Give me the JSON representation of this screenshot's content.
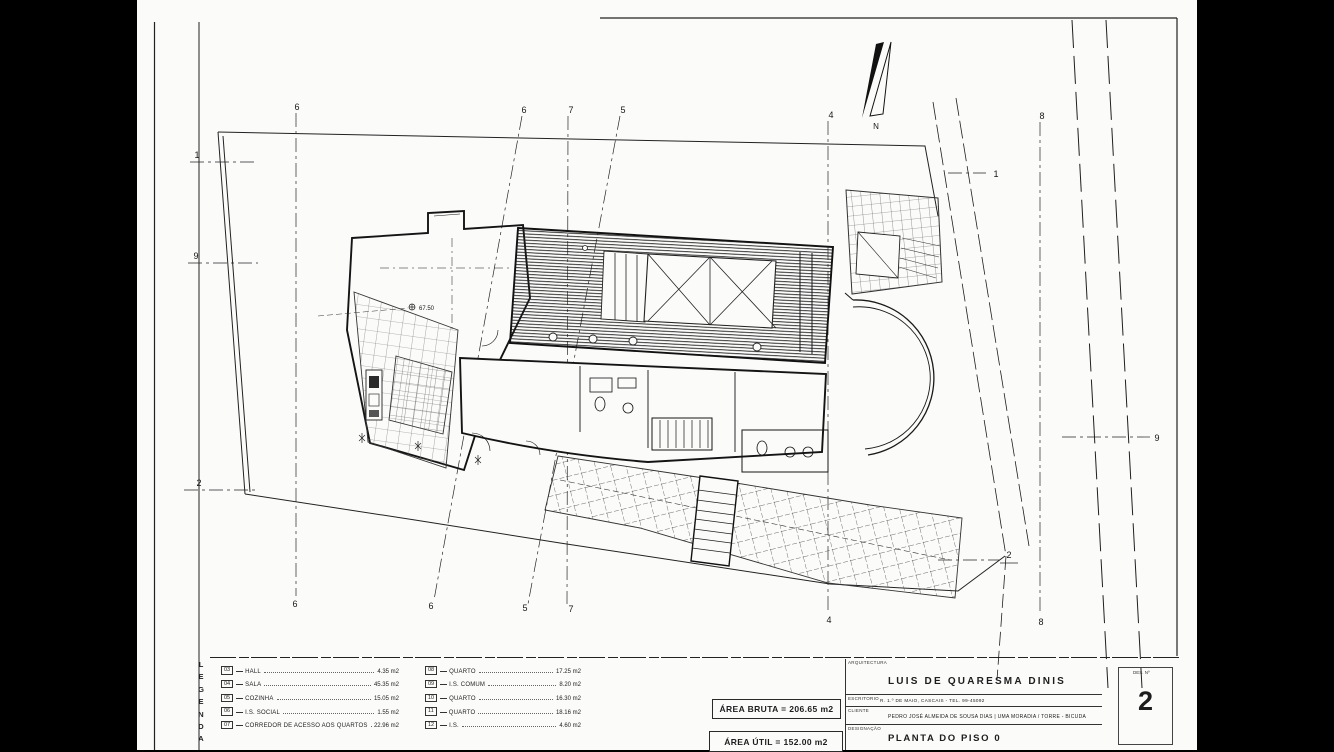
{
  "sheet": {
    "legend_title": "LEGENDA",
    "legend": {
      "left": [
        {
          "num": "03",
          "label": "HALL",
          "area": "4.35 m2"
        },
        {
          "num": "04",
          "label": "SALA",
          "area": "45.35 m2"
        },
        {
          "num": "05",
          "label": "COZINHA",
          "area": "15.05 m2"
        },
        {
          "num": "06",
          "label": "I.S. SOCIAL",
          "area": "1.55 m2"
        },
        {
          "num": "07",
          "label": "CORREDOR DE ACESSO AOS QUARTOS",
          "area": "22.96 m2"
        }
      ],
      "right": [
        {
          "num": "08",
          "label": "QUARTO",
          "area": "17.25 m2"
        },
        {
          "num": "09",
          "label": "I.S. COMUM",
          "area": "8.20 m2"
        },
        {
          "num": "10",
          "label": "QUARTO",
          "area": "16.30 m2"
        },
        {
          "num": "11",
          "label": "QUARTO",
          "area": "18.16 m2"
        },
        {
          "num": "12",
          "label": "I.S.",
          "area": "4.60 m2"
        }
      ]
    },
    "area_boxes": {
      "bruta": "ÁREA BRUTA = 206.65 m2",
      "util": "ÁREA ÚTIL = 152.00 m2"
    },
    "title_block": {
      "section_label": "ARQUITECTURA",
      "architect": "LUIS DE QUARESMA DINIS",
      "office_label": "ESCRITORIO",
      "office": "R. 1.º DE MAIO, CASCAIS - TEL. 99-45092",
      "client_label": "CLIENTE",
      "client": "PEDRO JOSÉ ALMEIDA DE SOUSA DIAS | UMA MORADIA / TORRE - BICUDA",
      "designation_label": "DESIGNAÇÃO",
      "designation": "PLANTA DO PISO 0",
      "number_label": "DES. Nº",
      "number": "2"
    },
    "plan": {
      "north": "N",
      "spot_level": "67.50",
      "grid": {
        "top": [
          "6",
          "6",
          "7",
          "5",
          "4",
          "8"
        ],
        "bottom": [
          "6",
          "6",
          "5",
          "7",
          "4",
          "8"
        ],
        "left": [
          "1",
          "9",
          "2"
        ],
        "right": [
          "1",
          "9",
          "2"
        ]
      }
    },
    "colors": {
      "ink": "#1a1a1a",
      "paper": "#fbfbfa",
      "background": "#000000"
    }
  }
}
